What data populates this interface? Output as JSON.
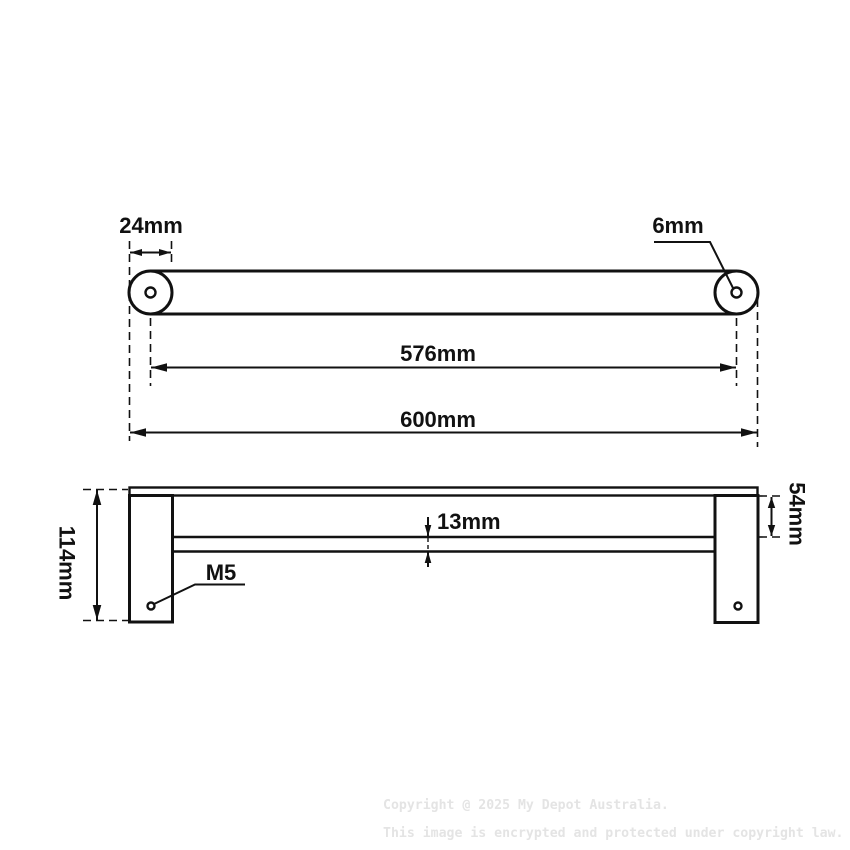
{
  "top_view": {
    "end_post_width": "24mm",
    "hole_diameter": "6mm",
    "hole_centre_distance": "576mm",
    "overall_length": "600mm"
  },
  "side_view": {
    "overall_height": "114mm",
    "top_drop": "54mm",
    "rail_thickness": "13mm",
    "screw_thread": "M5"
  },
  "watermark": {
    "line1": "Copyright @ 2025 My Depot Australia.",
    "line2": "This image is encrypted and protected under copyright law."
  },
  "colors": {
    "line": "#111111",
    "watermark": "#e4e4e4",
    "background": "#ffffff"
  }
}
